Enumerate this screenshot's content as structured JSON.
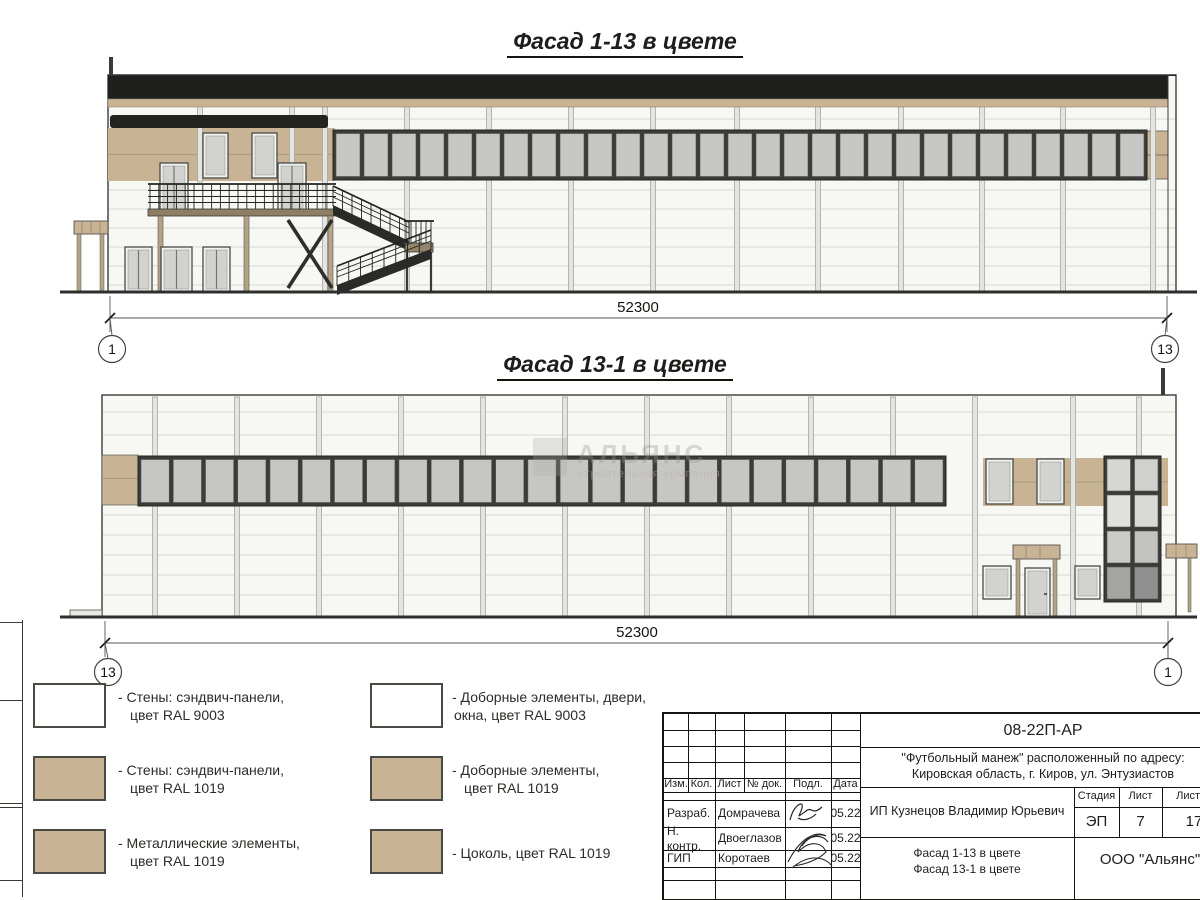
{
  "colors": {
    "tan": "#c8b494",
    "white": "#ffffff",
    "parapet": "#1f1f1e",
    "glass": "#c6c6c4",
    "frame": "#3b3b39",
    "stair": "#2a2a28",
    "wall": "#f7f7f4"
  },
  "facade1": {
    "title": "Фасад 1-13 в цвете",
    "dimension": "52300",
    "axis_left": "1",
    "axis_right": "13",
    "window_count": 29
  },
  "facade2": {
    "title": "Фасад 13-1 в цвете",
    "dimension": "52300",
    "axis_left": "13",
    "axis_right": "1",
    "window_count": 25
  },
  "watermark": {
    "line1": "АЛЬЯНС",
    "line2": "строительная компания"
  },
  "legend": {
    "items": [
      {
        "swatch": "white",
        "line1": "- Стены: сэндвич-панели,",
        "line2": "цвет RAL 9003"
      },
      {
        "swatch": "tan",
        "line1": "- Стены: сэндвич-панели,",
        "line2": "цвет RAL 1019"
      },
      {
        "swatch": "tan",
        "line1": "- Металлические элементы,",
        "line2": "цвет RAL 1019"
      },
      {
        "swatch": "white",
        "line1": "- Доборные элементы, двери,",
        "line2": "окна, цвет RAL 9003"
      },
      {
        "swatch": "tan",
        "line1": "- Доборные элементы,",
        "line2": "цвет RAL 1019"
      },
      {
        "swatch": "tan",
        "line1": "- Цоколь, цвет RAL 1019",
        "line2": ""
      }
    ]
  },
  "titleblock": {
    "doc_number": "08-22П-АР",
    "project_line1": "\"Футбольный манеж\" расположенный по адресу:",
    "project_line2": "Кировская область, г. Киров, ул. Энтузиастов",
    "client": "ИП Кузнецов Владимир Юрьевич",
    "header": {
      "izm": "Изм.",
      "kol": "Кол.",
      "list": "Лист",
      "doc": "№ док.",
      "podp": "Подл.",
      "data": "Дата"
    },
    "stage_label": "Стадия",
    "sheet_label": "Лист",
    "sheets_label": "Листов",
    "stage": "ЭП",
    "sheet_num": "7",
    "sheets_total": "17",
    "rows": [
      {
        "role": "Разраб.",
        "name": "Домрачева",
        "date": "05.22"
      },
      {
        "role": "Н. контр.",
        "name": "Двоеглазов",
        "date": "05.22"
      },
      {
        "role": "ГИП",
        "name": "Коротаев",
        "date": "05.22"
      }
    ],
    "drawing_title_line1": "Фасад 1-13 в цвете",
    "drawing_title_line2": "Фасад 13-1 в цвете",
    "organization": "ООО \"Альянс\""
  }
}
